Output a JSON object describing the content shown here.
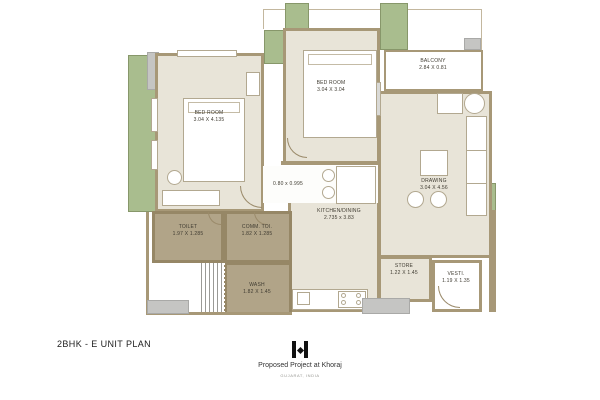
{
  "title_block": {
    "plan_title": "2BHK - E UNIT PLAN",
    "project_name": "Proposed Project at Khoraj",
    "project_location": "GUJARAT, INDIA"
  },
  "rooms": [
    {
      "id": "bedroom-1",
      "label": "BED ROOM",
      "dim": "3.04 X 4.135"
    },
    {
      "id": "bedroom-2",
      "label": "BED ROOM",
      "dim": "3.04 X 3.04"
    },
    {
      "id": "balcony",
      "label": "BALCONY",
      "dim": "2.84 X 0.81"
    },
    {
      "id": "drawing",
      "label": "DRAWING",
      "dim": "3.04 X 4.56"
    },
    {
      "id": "kitchen-dining",
      "label": "KITCHEN/DINING",
      "dim": "2.735 x 3.83"
    },
    {
      "id": "toilet",
      "label": "TOILET",
      "dim": "1.97 X 1.285"
    },
    {
      "id": "common-toilet",
      "label": "COMM. TOI.",
      "dim": "1.82 X 1.285"
    },
    {
      "id": "wash",
      "label": "WASH",
      "dim": "1.82 X 1.45"
    },
    {
      "id": "store",
      "label": "STORE",
      "dim": "1.22 X 1.45"
    },
    {
      "id": "vestibule",
      "label": "VESTI.",
      "dim": "1.19 X 1.35"
    }
  ],
  "passage": {
    "dim": "0.80 x 0.995"
  },
  "icons": {
    "logo": "twin-bars-diamond-logo"
  },
  "colors": {
    "wall": "#a79877",
    "floor": "#e8e4d8",
    "wet_floor": "#b1a488",
    "green": "#a9bd8e",
    "gray": "#c5c5c3",
    "paper": "#ffffff"
  }
}
